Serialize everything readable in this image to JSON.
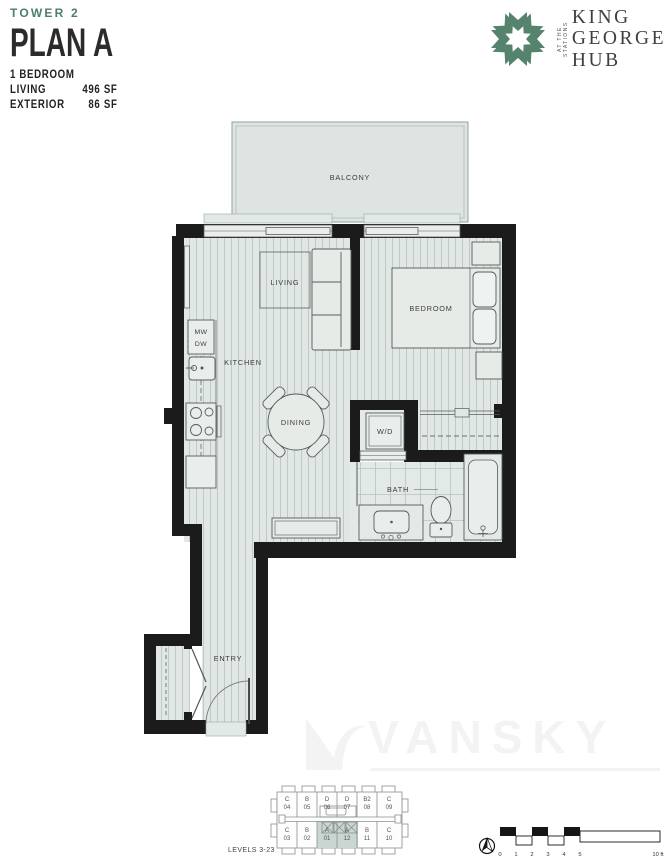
{
  "header": {
    "tower": "TOWER 2",
    "plan_name": "PLAN A",
    "bedrooms": "1 BEDROOM",
    "stats": [
      {
        "label": "LIVING",
        "value": "496 SF"
      },
      {
        "label": "EXTERIOR",
        "value": "86 SF"
      }
    ]
  },
  "logo": {
    "name_line1": "KING",
    "name_line2": "GEORGE",
    "name_line3": "HUB",
    "tagline": "AT THE STATIONS"
  },
  "plan": {
    "labels": {
      "balcony": "BALCONY",
      "living": "LIVING",
      "bedroom": "BEDROOM",
      "kitchen": "KITCHEN",
      "dining": "DINING",
      "wd": "W/D",
      "bath": "BATH",
      "entry": "ENTRY",
      "mw": "MW",
      "dw": "DW"
    }
  },
  "keyplan": {
    "levels_label": "LEVELS 3-23",
    "top_units": [
      {
        "letter": "C",
        "number": "04"
      },
      {
        "letter": "B",
        "number": "05"
      },
      {
        "letter": "D",
        "number": "06"
      },
      {
        "letter": "D",
        "number": "07"
      },
      {
        "letter": "B2",
        "number": "08"
      },
      {
        "letter": "C",
        "number": "09"
      }
    ],
    "bottom_units": [
      {
        "letter": "C",
        "number": "03"
      },
      {
        "letter": "B",
        "number": "02"
      },
      {
        "letter": "A",
        "number": "01"
      },
      {
        "letter": "A",
        "number": "12"
      },
      {
        "letter": "B",
        "number": "11"
      },
      {
        "letter": "C",
        "number": "10"
      }
    ],
    "highlighted_units": [
      "A 01",
      "A 12"
    ]
  },
  "scalebar": {
    "ticks": [
      "0",
      "1",
      "2",
      "3",
      "4",
      "5"
    ],
    "end_label": "10 ft"
  },
  "watermark": {
    "text": "VANSKY"
  },
  "colors": {
    "accent_teal": "#4d7d6e",
    "logo_green": "#55836e",
    "wall": "#1b1b1b",
    "floor": "#e0e7e4",
    "keyplan_highlight": "#c9d6d1"
  }
}
